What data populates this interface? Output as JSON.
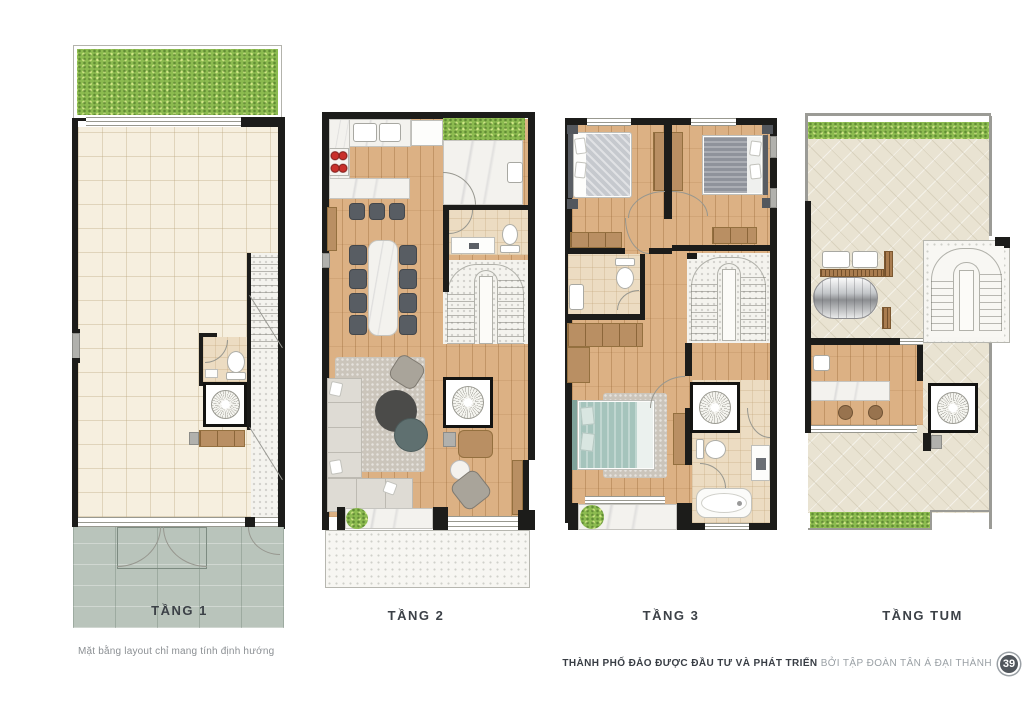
{
  "page": {
    "width": 1024,
    "height": 712,
    "background": "#ffffff"
  },
  "floors": [
    {
      "id": "tang-1",
      "label": "TẦNG 1"
    },
    {
      "id": "tang-2",
      "label": "TẦNG 2"
    },
    {
      "id": "tang-3",
      "label": "TẦNG 3"
    },
    {
      "id": "tang-tum",
      "label": "TẦNG TUM"
    }
  ],
  "footer": {
    "disclaimer": "Mặt bằng layout chỉ mang tính định hướng",
    "credit_bold": "THÀNH PHỐ ĐẢO ĐƯỢC ĐẦU TƯ VÀ PHÁT TRIỂN",
    "credit_light": "BỞI TẬP ĐOÀN TÂN Á ĐẠI THÀNH",
    "page_number": "39"
  },
  "colors": {
    "wall": "#1c1c1a",
    "wood_floor": "#dcb184",
    "tile_cream": "#f6efdf",
    "grass": "#8cbb50",
    "driveway": "#b9c4bb",
    "terrace_stone": "#e9e3d2",
    "marble": "#f3f2ee",
    "bath_beige": "#ecdcc2",
    "teal_bed": "#a5c4bc",
    "label_text": "#3c4147",
    "credit_light": "#9aa0a5"
  }
}
